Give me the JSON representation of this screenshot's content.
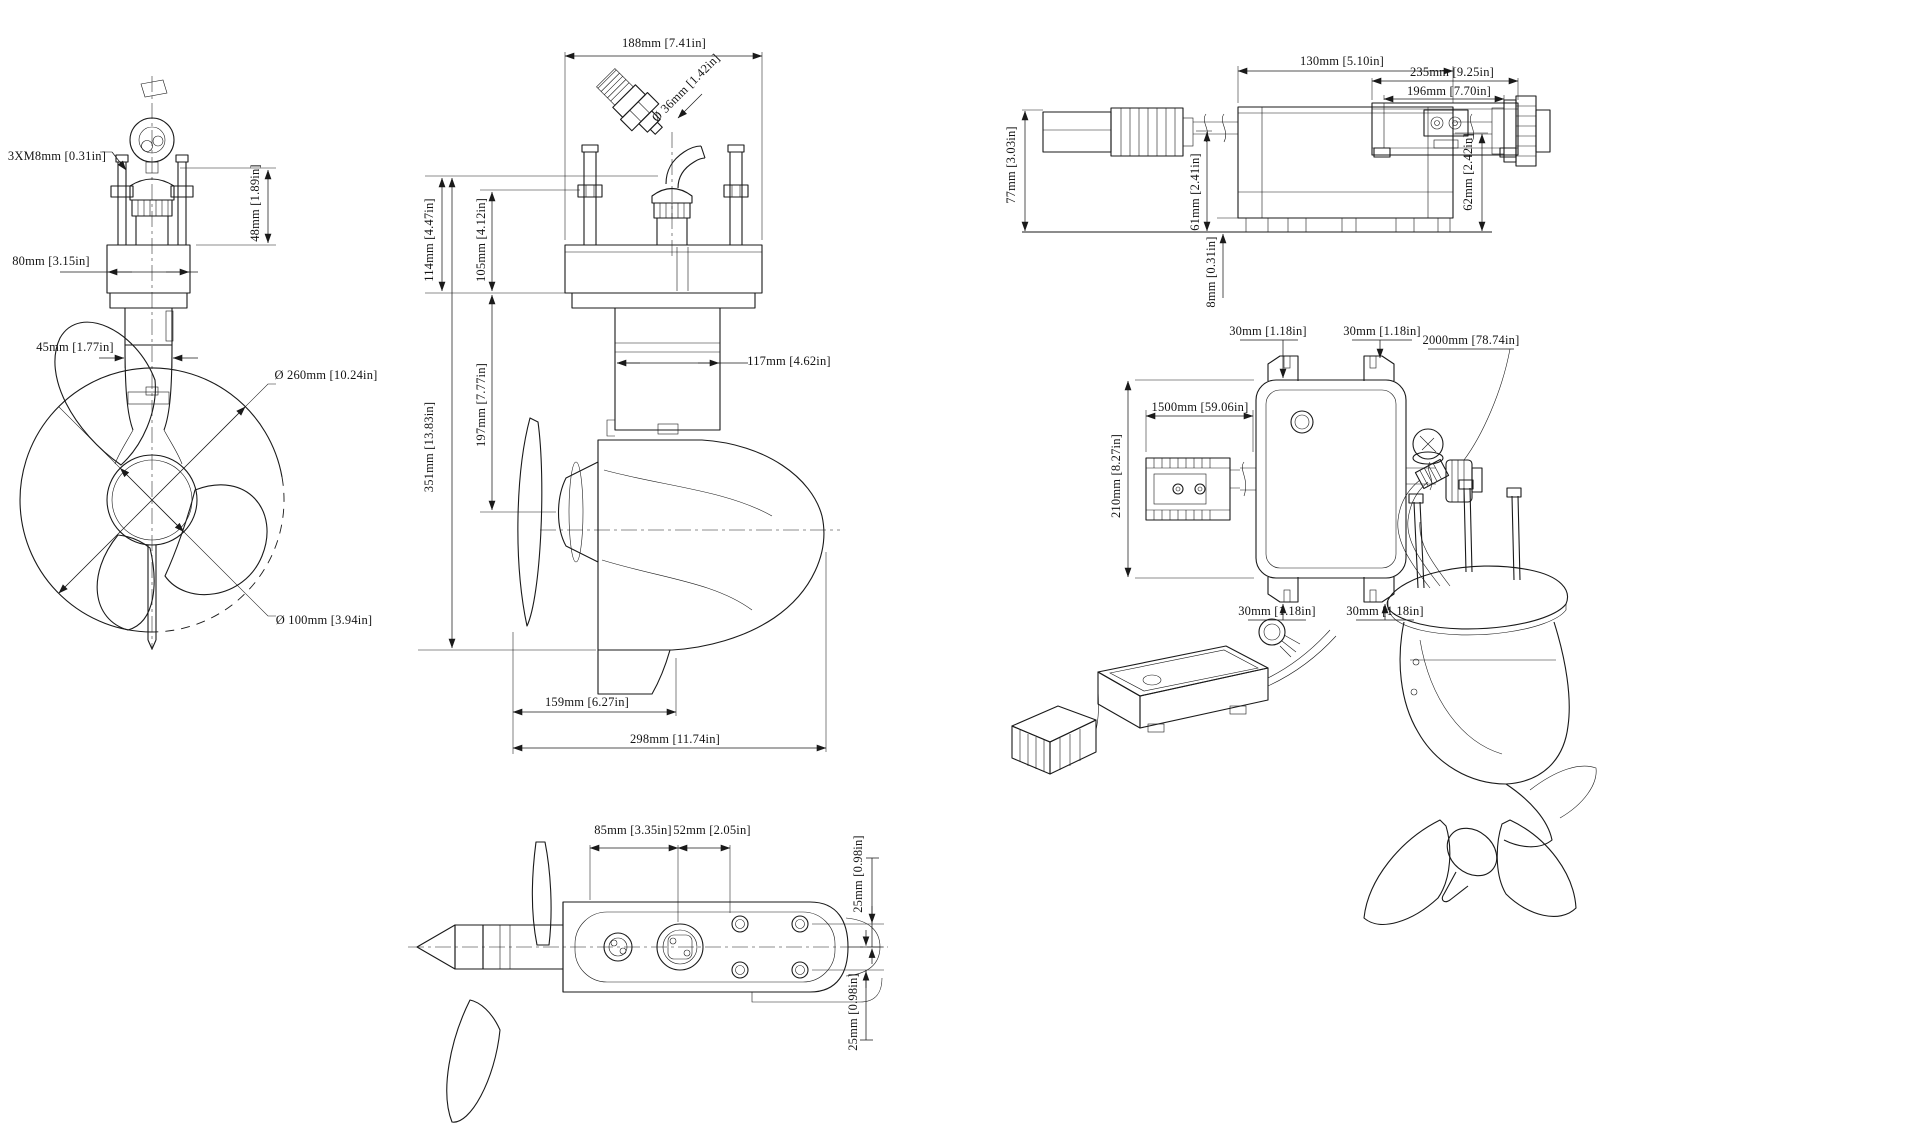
{
  "views": {
    "motor_front": {
      "dims": {
        "mount_bolts": "3XM8mm [0.31in]",
        "clamp_width": "80mm [3.15in]",
        "head_height": "48mm [1.89in]",
        "shaft_diameter": "45mm [1.77in]",
        "propeller_diameter": "Ø 260mm [10.24in]",
        "hub_diameter": "Ø 100mm [3.94in]"
      }
    },
    "motor_side": {
      "dims": {
        "flange_length": "188mm [7.41in]",
        "connector_diameter": "Ø 36mm [1.42in]",
        "flange_height_total": "114mm [4.47in]",
        "stud_height": "105mm [4.12in]",
        "body_width": "117mm [4.62in]",
        "shaft_length": "197mm [7.77in]",
        "overall_height": "351mm [13.83in]",
        "gearcase_length": "159mm [6.27in]",
        "overall_length": "298mm [11.74in]"
      }
    },
    "motor_top": {
      "dims": {
        "port_spacing": "85mm [3.35in]",
        "screw_spacing": "52mm [2.05in]",
        "screw_offset_upper": "25mm [0.98in]",
        "screw_offset_lower": "25mm [0.98in]"
      }
    },
    "controller_side": {
      "dims": {
        "body_length": "130mm [5.10in]",
        "overall_height": "77mm [3.03in]",
        "body_height": "61mm [2.41in]",
        "connector_height": "62mm [2.42in]",
        "foot_height": "8mm [0.31in]"
      }
    },
    "controller_end": {
      "dims": {
        "overall_width": "235mm [9.25in]",
        "body_width": "196mm [7.70in]"
      }
    },
    "controller_top": {
      "dims": {
        "tab_top_left": "30mm [1.18in]",
        "tab_top_right": "30mm [1.18in]",
        "motor_cable_length": "2000mm [78.74in]",
        "battery_cable_length": "1500mm [59.06in]",
        "body_height": "210mm [8.27in]",
        "tab_bottom_left": "30mm [1.18in]",
        "tab_bottom_right": "30mm [1.18in]"
      }
    }
  }
}
